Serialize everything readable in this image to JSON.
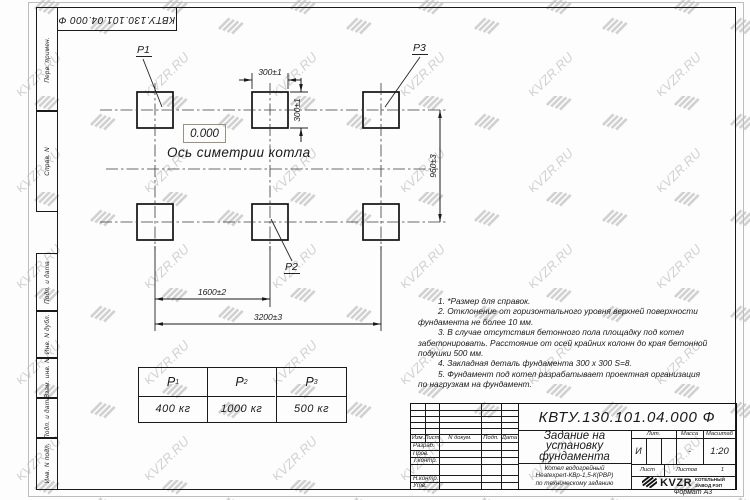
{
  "watermark": {
    "text": "KVZR.RU"
  },
  "frame": {
    "rotated_designation": "КВТУ.130.101.04.000  Ф",
    "side_labels": {
      "perv_primen": "Перв. примен.",
      "sprav_n": "Справ. N",
      "podp_data_1": "Подп. и дата",
      "inv_n_dubl": "Инв. N дубл.",
      "vzam_inv_n": "Взам. инв. N",
      "podp_data_2": "Подп. и дата",
      "inv_n_podl": "Инв. N подл."
    },
    "format_label": "Формат А3"
  },
  "drawing": {
    "pad_labels": {
      "p1": "P1",
      "p2": "P2",
      "p3": "P3"
    },
    "elevation_mark": "0.000",
    "axis_label": "Ось симетрии котла",
    "dimensions": {
      "pad_width": "300±1",
      "pad_height": "300±1",
      "row_pitch": "960±3",
      "col_pitch": "1600±2",
      "total_span": "3200±3"
    }
  },
  "loads_table": {
    "headers": [
      {
        "base": "P",
        "sub": "1"
      },
      {
        "base": "P",
        "sub": "2"
      },
      {
        "base": "P",
        "sub": "3"
      }
    ],
    "values": [
      "400 кг",
      "1000 кг",
      "500 кг"
    ]
  },
  "notes": {
    "lines": [
      "1. *Размер для справок.",
      "2. Отклонение от горизонтального уровня верхней поверхности",
      "фундамента не более 10 мм.",
      "3. В случае отсутствия бетонного пола площадку под котел",
      "забетонировать. Расстояние от осей крайних колонн до края бетонной",
      "подушки 500 мм.",
      "4. Закладная деталь фундамента  300 x 300 S=8.",
      "5. Фундамент под котел разрабатывает проектная организация",
      "по нагрузкам на фундамент."
    ]
  },
  "title_block": {
    "designation": "КВТУ.130.101.04.000  Ф",
    "doc_title_lines": [
      "Задание на",
      "установку",
      "фундамента"
    ],
    "product_lines": [
      "Котел водогрейный",
      "Heatexpert-КВр-1,5-К(РВР)",
      "по техническому заданию"
    ],
    "header_cols": {
      "izm": "Изм.",
      "list": "Лист",
      "n_dokum": "N докум.",
      "podp": "Подп.",
      "data": "Дата"
    },
    "sig_rows": {
      "razrab": "Разраб.",
      "prov": "Пров.",
      "t_kontr": "Т.контр.",
      "n_kontr": "Н.контр.",
      "utv": "Утв."
    },
    "lit_header": "Лит.",
    "massa_header": "Масса",
    "masshtab_header": "Масштаб",
    "lit_value": "И",
    "massa_value": "-",
    "masshtab_value": "1:20",
    "list_label": "Лист",
    "listov_label": "Листов",
    "listov_value": "1",
    "logo_text": "KVZR",
    "logo_caption_lines": [
      "КОТЕЛЬНЫЙ",
      "ЗАВОД РЭП"
    ]
  }
}
